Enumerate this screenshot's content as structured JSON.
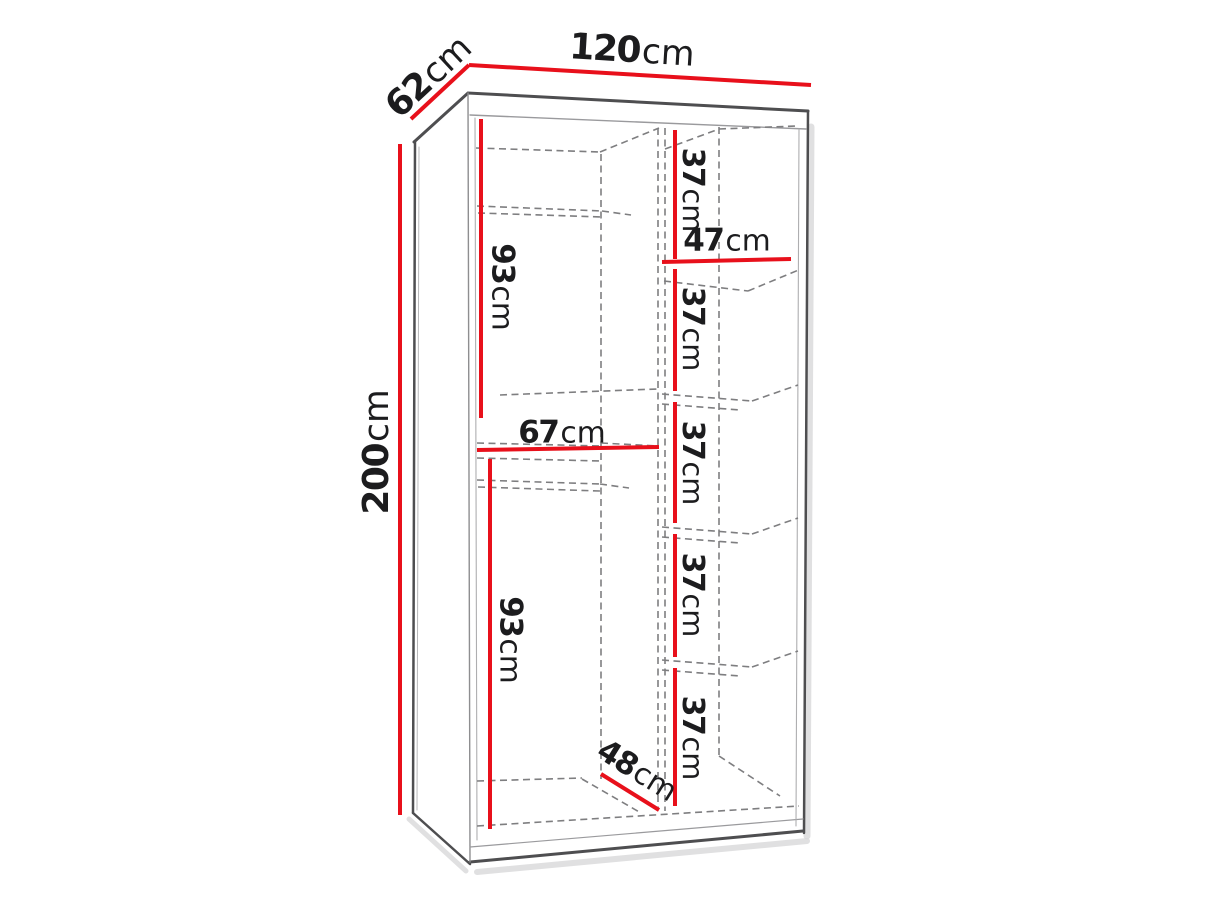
{
  "diagram": {
    "title": "wardrobe-interior-dimensions",
    "colors": {
      "dimension_line": "#e8101b",
      "outline_dark": "#4e4e50",
      "outline_light": "#9a9a9d",
      "dashed_line": "#7e7e80",
      "text": "#1c1c1e",
      "shadow": "#d8d8da",
      "background": "#ffffff"
    },
    "labels": {
      "width": {
        "value": "120",
        "unit": "cm"
      },
      "depth": {
        "value": "62",
        "unit": "cm"
      },
      "height": {
        "value": "200",
        "unit": "cm"
      },
      "upper_left_section": {
        "value": "93",
        "unit": "cm"
      },
      "left_shelf_width": {
        "value": "67",
        "unit": "cm"
      },
      "lower_left_section": {
        "value": "93",
        "unit": "cm"
      },
      "bottom_depth": {
        "value": "48",
        "unit": "cm"
      },
      "right_shelf_width": {
        "value": "47",
        "unit": "cm"
      },
      "right_section_1": {
        "value": "37",
        "unit": "cm"
      },
      "right_section_2": {
        "value": "37",
        "unit": "cm"
      },
      "right_section_3": {
        "value": "37",
        "unit": "cm"
      },
      "right_section_4": {
        "value": "37",
        "unit": "cm"
      },
      "right_section_5": {
        "value": "37",
        "unit": "cm"
      }
    }
  }
}
